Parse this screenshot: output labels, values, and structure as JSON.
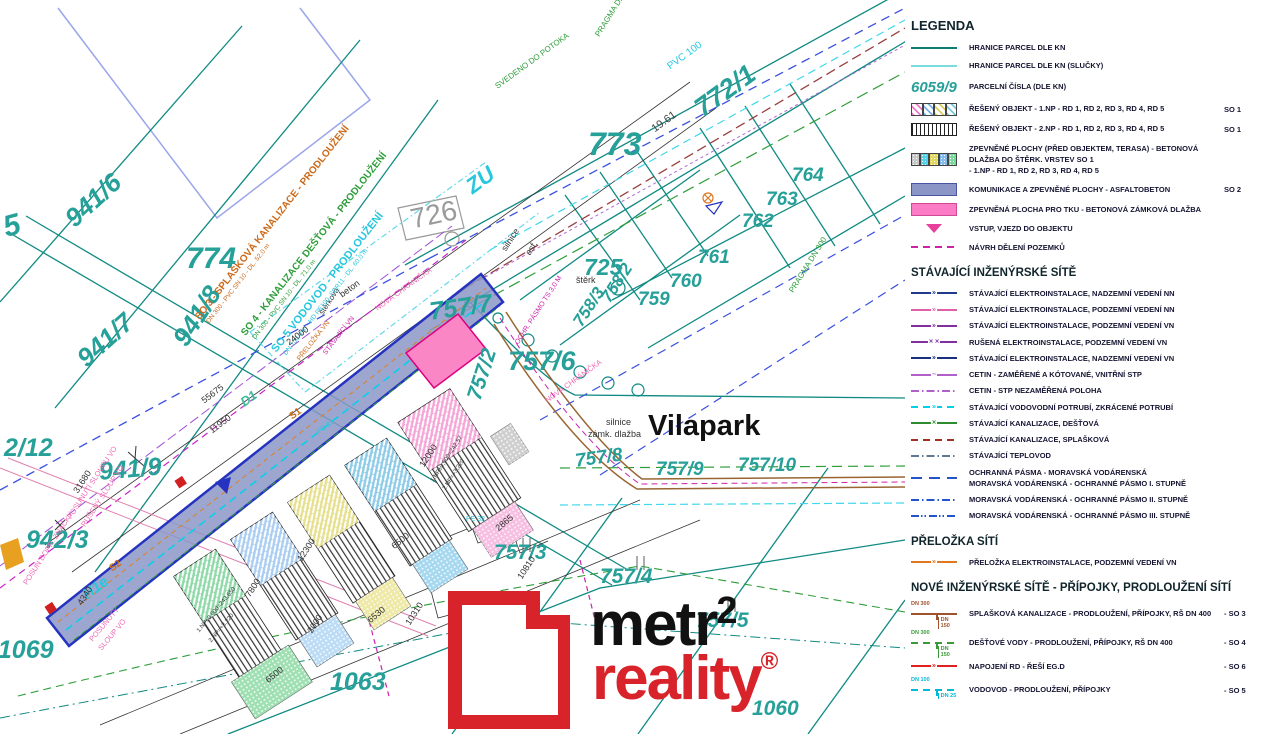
{
  "colors": {
    "teal_parcel": "#26a099",
    "teal_line": "#0f8a82",
    "road_fill": "#8c96c6",
    "road_edge": "#2633c0",
    "pink_area": "#fa86c6",
    "magenta": "#cc22aa",
    "orange": "#cc6a1a",
    "green": "#2e9e3a",
    "cyan": "#27c7de",
    "logo_red": "#d8232a"
  },
  "legend": {
    "title": "LEGENDA",
    "groups": [
      {
        "header": null,
        "cls": "lg-row",
        "items": [
          {
            "swatch": "line_parcel",
            "label": "HRANICE PARCEL DLE KN"
          },
          {
            "swatch": "line_parcel_slucky",
            "label": "HRANICE PARCEL DLE KN (SLUČKY)"
          },
          {
            "swatch": "parcel_number",
            "sample": "6059/9",
            "label": "PARCELNÍ ČÍSLA (DLE KN)"
          },
          {
            "swatch": "hatch_multi",
            "label": "ŘEŠENÝ OBJEKT - 1.NP - RD 1, RD 2, RD 3, RD 4, RD 5",
            "code": "SO 1"
          },
          {
            "swatch": "stripes",
            "label": "ŘEŠENÝ OBJEKT - 2.NP - RD 1, RD 2, RD 3, RD 4, RD 5",
            "code": "SO 1"
          },
          {
            "swatch": "dots_multi",
            "label": "ZPEVNĚNÉ PLOCHY (PŘED OBJEKTEM, TERASA) - BETONOVÁ DLAŽBA DO  ŠTĚRK. VRSTEV",
            "label2": "- 1.NP - RD 1, RD 2, RD 3, RD 4, RD 5",
            "code2": "SO 1"
          },
          {
            "swatch": "solid_periwinkle",
            "label": "KOMUNIKACE A ZPEVNĚNÉ PLOCHY - ASFALTOBETON",
            "code": "SO 2"
          },
          {
            "swatch": "solid_pink",
            "label": "ZPEVNĚNÁ PLOCHA PRO TKU - BETONOVÁ ZÁMKOVÁ DLAŽBA"
          },
          {
            "swatch": "triangle_pink",
            "label": "VSTUP, VJEZD DO OBJEKTU"
          },
          {
            "swatch": "dash_magenta",
            "label": "NÁVRH DĚLENÍ POZEMKŮ"
          }
        ]
      },
      {
        "header": "STÁVAJÍCÍ INŽENÝRSKÉ SÍTĚ",
        "cls": "lg-row lg-rowD",
        "items": [
          {
            "swatch": "nn_nadzemni",
            "label": "STÁVAJÍCÍ ELEKTROINSTALACE, NADZEMNÍ VEDENÍ NN"
          },
          {
            "swatch": "nn_podzemni",
            "label": "STÁVAJÍCÍ ELEKTROINSTALACE, PODZEMNÍ VEDENÍ NN"
          },
          {
            "swatch": "vn_podzemni",
            "label": "STÁVAJÍCÍ ELEKTROINSTALACE, PODZEMNÍ VEDENÍ VN"
          },
          {
            "swatch": "vn_rusena",
            "label": "RUŠENÁ ELEKTROINSTALACE, PODZEMNÍ VEDENÍ VN"
          },
          {
            "swatch": "vn_nadzemni",
            "label": "STÁVAJÍCÍ ELEKTROINSTALACE, NADZEMNÍ VEDENÍ VN"
          },
          {
            "swatch": "cetin",
            "label": "CETIN - ZAMĚŘENÉ A KÓTOVANÉ, VNITŘNÍ STP"
          },
          {
            "swatch": "cetin_nez",
            "label": "CETIN - STP NEZAMĚŘENÁ POLOHA"
          },
          {
            "swatch": "vodovod",
            "label": "STÁVAJÍCÍ VODOVODNÍ POTRUBÍ, ZKRÁCENÉ POTRUBÍ"
          },
          {
            "swatch": "kanal_dest",
            "label": "STÁVAJÍCÍ KANALIZACE, DEŠŤOVÁ"
          },
          {
            "swatch": "kanal_splask",
            "label": "STÁVAJÍCÍ KANALIZACE, SPLAŠKOVÁ"
          },
          {
            "swatch": "teplovod",
            "label": "STÁVAJÍCÍ TEPLOVOD"
          },
          {
            "swatch": "pasmo1",
            "label": "OCHRANNÁ PÁSMA - MORAVSKÁ VODÁRENSKÁ",
            "label2": "MORAVSKÁ VODÁRENSKÁ - OCHRANNÉ PÁSMO I. STUPNĚ"
          },
          {
            "swatch": "pasmo2",
            "label": "MORAVSKÁ VODÁRENSKÁ - OCHRANNÉ PÁSMO II. STUPNĚ"
          },
          {
            "swatch": "pasmo3",
            "label": "MORAVSKÁ VODÁRENSKÁ - OCHRANNÉ PÁSMO III. STUPNĚ"
          }
        ]
      },
      {
        "header": "PŘELOŽKA SÍTÍ",
        "cls": "lg-row lg-rowD",
        "items": [
          {
            "swatch": "prelozka",
            "label": "PŘELOŽKA ELEKTROINSTALACE, PODZEMNÍ VEDENÍ VN"
          }
        ]
      },
      {
        "header": "NOVÉ INŽENÝRSKÉ SÍTĚ -  PŘÍPOJKY, PRODLOUŽENÍ SÍTÍ",
        "cls": "lg-row",
        "items": [
          {
            "swatch": "tee_brown",
            "dn_top": "DN 300",
            "dn_bottom": "DN 150",
            "label": "SPLAŠKOVÁ KANALIZACE - PRODLOUŽENÍ, PŘÍPOJKY, RŠ DN 400",
            "code": "- SO 3"
          },
          {
            "swatch": "tee_green",
            "dn_top": "DN 300",
            "dn_bottom": "DN 150",
            "label": "DEŠŤOVÉ VODY - PRODLOUŽENÍ, PŘÍPOJKY, RŠ DN 400",
            "code": "- SO 4"
          },
          {
            "swatch": "line_red",
            "label": "NAPOJENÍ RD - ŘEŠÍ EG.D",
            "code": "- SO 6"
          },
          {
            "swatch": "tee_cyan",
            "dn_top": "DN 100",
            "dn_bottom": "DN 25",
            "label": "VODOVOD - PRODLOUŽENÍ, PŘÍPOJKY",
            "code": "- SO 5"
          }
        ]
      }
    ]
  },
  "elevations": [
    {
      "label": "RD 1",
      "value": "±0,000=242,57",
      "color": "#000000"
    },
    {
      "label": "RD 2",
      "value": "±0,000=242,82",
      "color": "#1f5fd6"
    },
    {
      "label": "RD 3",
      "value": "±0,000=243,110",
      "color": "#f08a24"
    },
    {
      "label": "RD 4",
      "value": "±0,000=243,400",
      "color": "#000000"
    },
    {
      "label": "RD 5",
      "value": "±0,000=243,650",
      "color": "#000000"
    }
  ],
  "north": {
    "label": "S"
  },
  "logo": {
    "word1": "metr",
    "sup": "2",
    "word2": "reality",
    "reg": "®"
  },
  "map": {
    "street_name": "Vilapark",
    "labels": [
      {
        "t": "5",
        "x": 0,
        "y": 214,
        "r": -15,
        "s": 30,
        "c": "#26a099",
        "b": 1,
        "i": 1
      },
      {
        "t": "941/6",
        "x": 60,
        "y": 212,
        "r": -42,
        "s": 26,
        "c": "#26a099",
        "b": 1,
        "i": 1
      },
      {
        "t": "941/7",
        "x": 72,
        "y": 352,
        "r": -42,
        "s": 26,
        "c": "#26a099",
        "b": 1,
        "i": 1
      },
      {
        "t": "941/8",
        "x": 168,
        "y": 336,
        "r": -57,
        "s": 26,
        "c": "#26a099",
        "b": 1,
        "i": 1
      },
      {
        "t": "774",
        "x": 186,
        "y": 244,
        "r": 0,
        "s": 30,
        "c": "#26a099",
        "b": 1,
        "i": 1
      },
      {
        "t": "2/12",
        "x": 4,
        "y": 436,
        "r": 0,
        "s": 25,
        "c": "#26a099",
        "b": 1,
        "i": 1
      },
      {
        "t": "941/9",
        "x": 98,
        "y": 460,
        "r": -5,
        "s": 25,
        "c": "#26a099",
        "b": 1,
        "i": 1
      },
      {
        "t": "942/3",
        "x": 26,
        "y": 528,
        "r": 0,
        "s": 25,
        "c": "#26a099",
        "b": 1,
        "i": 1
      },
      {
        "t": "41069",
        "x": -16,
        "y": 638,
        "r": 0,
        "s": 25,
        "c": "#26a099",
        "b": 1,
        "i": 1
      },
      {
        "t": "1063",
        "x": 330,
        "y": 670,
        "r": 0,
        "s": 25,
        "c": "#26a099",
        "b": 1,
        "i": 1
      },
      {
        "t": "726",
        "x": 408,
        "y": 206,
        "r": -12,
        "s": 28,
        "c": "#9a9a9a",
        "b": 0
      },
      {
        "t": "ZU",
        "x": 462,
        "y": 180,
        "r": -36,
        "s": 22,
        "c": "#27c7de",
        "b": 1,
        "i": 1
      },
      {
        "t": "773",
        "x": 588,
        "y": 128,
        "r": 0,
        "s": 32,
        "c": "#26a099",
        "b": 1,
        "i": 1
      },
      {
        "t": "772/1",
        "x": 690,
        "y": 100,
        "r": -36,
        "s": 27,
        "c": "#26a099",
        "b": 1,
        "i": 1
      },
      {
        "t": "19.61",
        "x": 650,
        "y": 126,
        "r": -36,
        "s": 11,
        "c": "#444444"
      },
      {
        "t": "PVC 100",
        "x": 666,
        "y": 64,
        "r": -36,
        "s": 10,
        "c": "#27c7de"
      },
      {
        "t": "PRAGMA DN 300",
        "x": 594,
        "y": 34,
        "r": -58,
        "s": 8,
        "c": "#2e9e3a"
      },
      {
        "t": "PRAGMA DN 300",
        "x": 788,
        "y": 290,
        "r": -58,
        "s": 8,
        "c": "#2e9e3a"
      },
      {
        "t": "SVEDENO DO POTOKA",
        "x": 494,
        "y": 84,
        "r": -36,
        "s": 8,
        "c": "#2e9e3a"
      },
      {
        "t": "764",
        "x": 792,
        "y": 166,
        "r": 0,
        "s": 19,
        "c": "#26a099",
        "b": 1,
        "i": 1
      },
      {
        "t": "763",
        "x": 766,
        "y": 190,
        "r": 0,
        "s": 19,
        "c": "#26a099",
        "b": 1,
        "i": 1
      },
      {
        "t": "762",
        "x": 742,
        "y": 212,
        "r": 0,
        "s": 19,
        "c": "#26a099",
        "b": 1,
        "i": 1
      },
      {
        "t": "761",
        "x": 698,
        "y": 248,
        "r": 0,
        "s": 19,
        "c": "#26a099",
        "b": 1,
        "i": 1
      },
      {
        "t": "760",
        "x": 670,
        "y": 272,
        "r": 0,
        "s": 19,
        "c": "#26a099",
        "b": 1,
        "i": 1
      },
      {
        "t": "759",
        "x": 638,
        "y": 290,
        "r": 0,
        "s": 19,
        "c": "#26a099",
        "b": 1,
        "i": 1
      },
      {
        "t": "758/2",
        "x": 598,
        "y": 296,
        "r": -57,
        "s": 17,
        "c": "#26a099",
        "b": 1,
        "i": 1
      },
      {
        "t": "758/3",
        "x": 570,
        "y": 320,
        "r": -57,
        "s": 17,
        "c": "#26a099",
        "b": 1,
        "i": 1
      },
      {
        "t": "757/6",
        "x": 508,
        "y": 348,
        "r": 0,
        "s": 27,
        "c": "#26a099",
        "b": 1,
        "i": 1
      },
      {
        "t": "757/7",
        "x": 428,
        "y": 300,
        "r": -8,
        "s": 25,
        "c": "#26a099",
        "b": 1,
        "i": 1
      },
      {
        "t": "757/2",
        "x": 464,
        "y": 396,
        "r": -72,
        "s": 21,
        "c": "#26a099",
        "b": 1,
        "i": 1
      },
      {
        "t": "Vilapark",
        "x": 648,
        "y": 412,
        "r": 0,
        "s": 29,
        "c": "#111111",
        "b": 1
      },
      {
        "t": "silnice",
        "x": 606,
        "y": 418,
        "r": 0,
        "s": 9,
        "c": "#333333"
      },
      {
        "t": "zámk. dlažba",
        "x": 588,
        "y": 430,
        "r": 0,
        "s": 9,
        "c": "#333333"
      },
      {
        "t": "757/8",
        "x": 574,
        "y": 452,
        "r": -8,
        "s": 19,
        "c": "#26a099",
        "b": 1,
        "i": 1
      },
      {
        "t": "757/9",
        "x": 656,
        "y": 460,
        "r": 0,
        "s": 19,
        "c": "#26a099",
        "b": 1,
        "i": 1
      },
      {
        "t": "757/10",
        "x": 738,
        "y": 456,
        "r": 0,
        "s": 19,
        "c": "#26a099",
        "b": 1,
        "i": 1
      },
      {
        "t": "757/3",
        "x": 494,
        "y": 542,
        "r": 0,
        "s": 21,
        "c": "#26a099",
        "b": 1,
        "i": 1
      },
      {
        "t": "757/4",
        "x": 600,
        "y": 566,
        "r": 0,
        "s": 21,
        "c": "#26a099",
        "b": 1,
        "i": 1
      },
      {
        "t": "757/5",
        "x": 696,
        "y": 610,
        "r": 0,
        "s": 21,
        "c": "#26a099",
        "b": 1,
        "i": 1
      },
      {
        "t": "725",
        "x": 584,
        "y": 256,
        "r": 0,
        "s": 23,
        "c": "#26a099",
        "b": 1,
        "i": 1
      },
      {
        "t": "novo",
        "x": 506,
        "y": 606,
        "r": 0,
        "s": 11,
        "c": "#333333"
      },
      {
        "t": "štěrk",
        "x": 576,
        "y": 276,
        "r": 0,
        "s": 9,
        "c": "#333333"
      },
      {
        "t": "beton",
        "x": 338,
        "y": 292,
        "r": -36,
        "s": 9,
        "c": "#333333"
      },
      {
        "t": "štěrková",
        "x": 318,
        "y": 312,
        "r": -57,
        "s": 8,
        "c": "#333333"
      },
      {
        "t": "silnice",
        "x": 500,
        "y": 248,
        "r": -57,
        "s": 9,
        "c": "#333333"
      },
      {
        "t": "asf.",
        "x": 524,
        "y": 252,
        "r": -57,
        "s": 9,
        "c": "#333333"
      },
      {
        "t": "SO 3 - SPLAŠKOVÁ KANALIZACE - PRODLOUŽENÍ",
        "x": 194,
        "y": 316,
        "r": -52,
        "s": 10,
        "c": "#cc6a1a",
        "b": 1
      },
      {
        "t": "DN 300 - PVC SN 10 - DL. 52,0 m",
        "x": 206,
        "y": 321,
        "r": -52,
        "s": 6.5,
        "c": "#cc6a1a"
      },
      {
        "t": "SO 4 - KANALIZACE DEŠŤOVÁ - PRODLOUŽENÍ",
        "x": 240,
        "y": 332,
        "r": -52,
        "s": 10,
        "c": "#2e9e3a",
        "b": 1
      },
      {
        "t": "DN 300 - PVC SN 10 - DL. 71,0 m",
        "x": 252,
        "y": 337,
        "r": -52,
        "s": 6.5,
        "c": "#2e9e3a"
      },
      {
        "t": "SO 5  VODOVOD - PRODLOUŽENÍ",
        "x": 270,
        "y": 348,
        "r": -52,
        "s": 11,
        "c": "#27c7de",
        "b": 1
      },
      {
        "t": "DN 100 mm - HD PE100, SDR11 - DL. 60,0 m",
        "x": 283,
        "y": 353,
        "r": -52,
        "s": 6.5,
        "c": "#27c7de"
      },
      {
        "t": "PŘELOŽKA VN",
        "x": 296,
        "y": 358,
        "r": -52,
        "s": 7,
        "c": "#cc6a1a"
      },
      {
        "t": "STÁVAJÍCÍ VN",
        "x": 322,
        "y": 352,
        "r": -52,
        "s": 7,
        "c": "#cc22aa"
      },
      {
        "t": "NOVÁ CHRÁNIČKA",
        "x": 374,
        "y": 306,
        "r": -36,
        "s": 7.5,
        "c": "#f06ab4"
      },
      {
        "t": "NOVÁ CHRÁNIČKA",
        "x": 544,
        "y": 398,
        "r": -36,
        "s": 7.5,
        "c": "#f06ab4"
      },
      {
        "t": "OCHR. PÁSMO TS 3,0 M",
        "x": 514,
        "y": 342,
        "r": -57,
        "s": 7,
        "c": "#cc22aa"
      },
      {
        "t": "POSUNUTÍ SLOUPU VO",
        "x": 66,
        "y": 516,
        "r": -57,
        "s": 7.5,
        "c": "#f06ab4"
      },
      {
        "t": "RUŠENÝ SLOUP VO",
        "x": 80,
        "y": 524,
        "r": -57,
        "s": 7.5,
        "c": "#f06ab4"
      },
      {
        "t": "POSUN DOPR. ZNAČKY",
        "x": 22,
        "y": 582,
        "r": -57,
        "s": 7.5,
        "c": "#f06ab4"
      },
      {
        "t": "POSUNUTÝ",
        "x": 88,
        "y": 638,
        "r": -50,
        "s": 7.5,
        "c": "#f06ab4"
      },
      {
        "t": "SLOUP VO",
        "x": 97,
        "y": 647,
        "r": -50,
        "s": 7.5,
        "c": "#f06ab4"
      },
      {
        "t": "H1e",
        "x": 80,
        "y": 590,
        "r": -36,
        "s": 15,
        "c": "#27c7de",
        "b": 1,
        "i": 1
      },
      {
        "t": "D1",
        "x": 238,
        "y": 398,
        "r": -36,
        "s": 13,
        "c": "#3dbd9e",
        "b": 1,
        "i": 1
      },
      {
        "t": "S1",
        "x": 288,
        "y": 414,
        "r": -36,
        "s": 10,
        "c": "#cc6a1a",
        "b": 1
      },
      {
        "t": "S2",
        "x": 108,
        "y": 566,
        "r": -36,
        "s": 10,
        "c": "#cc6a1a",
        "b": 1
      },
      {
        "t": "PE 32",
        "x": 466,
        "y": 516,
        "r": 0,
        "s": 7,
        "c": "#27c7de"
      },
      {
        "t": "PE 32",
        "x": 316,
        "y": 430,
        "r": -36,
        "s": 7,
        "c": "#27c7de"
      },
      {
        "t": "24000",
        "x": 285,
        "y": 340,
        "r": -37,
        "s": 9,
        "c": "#333333"
      },
      {
        "t": "55675",
        "x": 200,
        "y": 398,
        "r": -37,
        "s": 9,
        "c": "#333333"
      },
      {
        "t": "11950",
        "x": 208,
        "y": 428,
        "r": -37,
        "s": 9,
        "c": "#333333"
      },
      {
        "t": "31680",
        "x": 72,
        "y": 490,
        "r": -57,
        "s": 9,
        "c": "#333333"
      },
      {
        "t": "4340",
        "x": 76,
        "y": 602,
        "r": -57,
        "s": 9,
        "c": "#333333"
      },
      {
        "t": "6500",
        "x": 264,
        "y": 678,
        "r": -40,
        "s": 9,
        "c": "#333333"
      },
      {
        "t": "6500",
        "x": 390,
        "y": 544,
        "r": -40,
        "s": 9,
        "c": "#333333"
      },
      {
        "t": "6530",
        "x": 366,
        "y": 618,
        "r": -40,
        "s": 9,
        "c": "#333333"
      },
      {
        "t": "2000",
        "x": 306,
        "y": 630,
        "r": -57,
        "s": 9,
        "c": "#333333"
      },
      {
        "t": "2865",
        "x": 494,
        "y": 526,
        "r": -40,
        "s": 9,
        "c": "#333333"
      },
      {
        "t": "10810",
        "x": 516,
        "y": 576,
        "r": -57,
        "s": 9,
        "c": "#333333"
      },
      {
        "t": "9560",
        "x": 496,
        "y": 658,
        "r": -57,
        "s": 9,
        "c": "#333333"
      },
      {
        "t": "7800",
        "x": 244,
        "y": 594,
        "r": -57,
        "s": 9,
        "c": "#333333"
      },
      {
        "t": "12300",
        "x": 296,
        "y": 558,
        "r": -57,
        "s": 9,
        "c": "#333333"
      },
      {
        "t": "12000",
        "x": 418,
        "y": 464,
        "r": -57,
        "s": 9,
        "c": "#333333"
      },
      {
        "t": "10310",
        "x": 404,
        "y": 622,
        "r": -57,
        "s": 9,
        "c": "#333333"
      },
      {
        "t": "1.NP±0,000=243,650",
        "x": 196,
        "y": 630,
        "r": -50,
        "s": 6,
        "c": "#333333"
      },
      {
        "t": "2.NP=+3,220",
        "x": 208,
        "y": 640,
        "r": -50,
        "s": 6,
        "c": "#333333"
      },
      {
        "t": "1.NP±0,000=242,57",
        "x": 430,
        "y": 480,
        "r": -57,
        "s": 6,
        "c": "#333333"
      },
      {
        "t": "2.NP=+3,220",
        "x": 442,
        "y": 488,
        "r": -57,
        "s": 6,
        "c": "#333333"
      },
      {
        "t": "1060",
        "x": 752,
        "y": 698,
        "r": 0,
        "s": 21,
        "c": "#26a099",
        "b": 1,
        "i": 1
      }
    ]
  }
}
